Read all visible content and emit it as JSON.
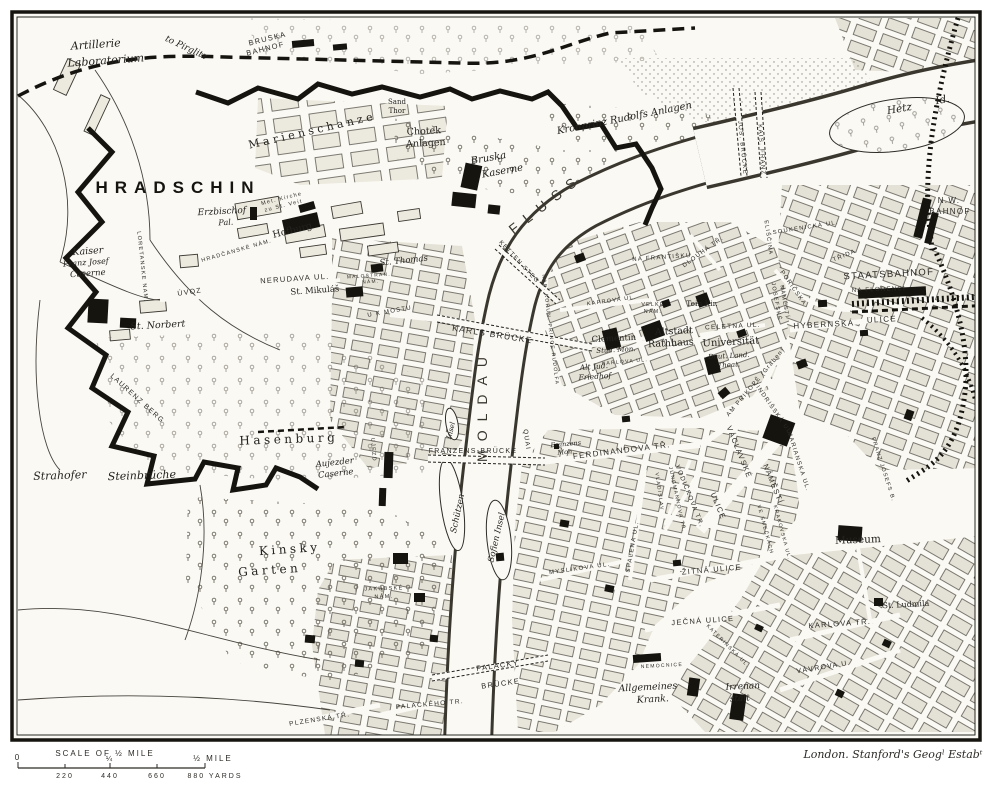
{
  "page": {
    "paper": "#faf9f4",
    "ink": "#24221e",
    "block_fill": "#e4e1d6",
    "imprint": "London. Stanford's Geogˡ Estabᵗ"
  },
  "scale_bar": {
    "title": "SCALE OF ½ MILE",
    "tick_zero": "0",
    "tick_quarter": "¼",
    "tick_half": "½ MILE",
    "yards_220": "220",
    "yards_440": "440",
    "yards_660": "660",
    "yards_880": "880 YARDS"
  },
  "map": {
    "labels": [
      {
        "t": "Artillerie",
        "x": 96,
        "y": 48,
        "r": -4,
        "s": 11,
        "f": "it"
      },
      {
        "t": "Laboratorium",
        "x": 106,
        "y": 64,
        "r": -4,
        "s": 11,
        "f": "it"
      },
      {
        "t": "to Pirglitz",
        "x": 185,
        "y": 50,
        "r": 25,
        "s": 9,
        "f": "it"
      },
      {
        "t": "BRUSKA",
        "x": 268,
        "y": 41,
        "r": -14,
        "s": 7.5,
        "f": "sp"
      },
      {
        "t": "BAHNOF",
        "x": 266,
        "y": 51,
        "r": -14,
        "s": 7.5,
        "f": "sp"
      },
      {
        "t": "Marienschanze",
        "x": 313,
        "y": 134,
        "r": -13,
        "s": 11,
        "f": "sp2"
      },
      {
        "t": "Sand",
        "x": 397,
        "y": 104,
        "r": 0,
        "s": 7,
        "f": "rm"
      },
      {
        "t": "Thor",
        "x": 397,
        "y": 113,
        "r": 0,
        "s": 7,
        "f": "rm"
      },
      {
        "t": "Chotek",
        "x": 424,
        "y": 134,
        "r": -3,
        "s": 9.5,
        "f": "rm"
      },
      {
        "t": "Anlagen",
        "x": 426,
        "y": 146,
        "r": -3,
        "s": 9.5,
        "f": "rm"
      },
      {
        "t": "Bruska",
        "x": 489,
        "y": 161,
        "r": -10,
        "s": 10,
        "f": "it"
      },
      {
        "t": "Kaserne",
        "x": 503,
        "y": 174,
        "r": -10,
        "s": 10,
        "f": "it"
      },
      {
        "t": "Kronprinz Rudolfs Anlagen",
        "x": 625,
        "y": 121,
        "r": -11,
        "s": 10,
        "f": "it"
      },
      {
        "t": "Hetz",
        "x": 900,
        "y": 112,
        "r": -10,
        "s": 10.5,
        "f": "it"
      },
      {
        "t": "Id.",
        "x": 943,
        "y": 103,
        "r": -10,
        "s": 10.5,
        "f": "it"
      },
      {
        "t": "N.W.",
        "x": 949,
        "y": 203,
        "r": 0,
        "s": 8,
        "f": "sp"
      },
      {
        "t": "BAHNOF",
        "x": 950,
        "y": 214,
        "r": 0,
        "s": 8,
        "f": "sp"
      },
      {
        "t": "KAIS. FRANZ",
        "x": 760,
        "y": 150,
        "r": 86,
        "s": 6,
        "f": "sp"
      },
      {
        "t": "JOS. BRÜCKE",
        "x": 741,
        "y": 148,
        "r": 84,
        "s": 6,
        "f": "sp"
      },
      {
        "t": "NA FRANTIŠKU",
        "x": 662,
        "y": 259,
        "r": -4,
        "s": 6,
        "f": "sp"
      },
      {
        "t": "HRADSCHIN",
        "x": 178,
        "y": 193,
        "r": 0,
        "s": 17,
        "f": "big"
      },
      {
        "t": "Erzbischof",
        "x": 222,
        "y": 214,
        "r": -3,
        "s": 9,
        "f": "it"
      },
      {
        "t": "Pal.",
        "x": 226,
        "y": 225,
        "r": -3,
        "s": 8,
        "f": "it"
      },
      {
        "t": "Met. Kirche",
        "x": 282,
        "y": 200,
        "r": -14,
        "s": 5.5,
        "f": "sp"
      },
      {
        "t": "zu St. Veit",
        "x": 284,
        "y": 207,
        "r": -14,
        "s": 5.5,
        "f": "sp"
      },
      {
        "t": "Hofburg",
        "x": 293,
        "y": 233,
        "r": -14,
        "s": 9.5,
        "f": "rm"
      },
      {
        "t": "Kaiser",
        "x": 88,
        "y": 254,
        "r": -4,
        "s": 9.5,
        "f": "it"
      },
      {
        "t": "Franz Josef",
        "x": 86,
        "y": 265,
        "r": -4,
        "s": 8,
        "f": "it"
      },
      {
        "t": "Caserne",
        "x": 88,
        "y": 276,
        "r": -4,
        "s": 8.5,
        "f": "it"
      },
      {
        "t": "LORETANSKE NAM.",
        "x": 141,
        "y": 267,
        "r": 84,
        "s": 5.5,
        "f": "sp"
      },
      {
        "t": "HRADČANSKÉ NÁM.",
        "x": 237,
        "y": 252,
        "r": -16,
        "s": 5.5,
        "f": "sp"
      },
      {
        "t": "NERUDAVA UL.",
        "x": 295,
        "y": 281,
        "r": -4,
        "s": 7.5,
        "f": "sp"
      },
      {
        "t": "St. Mikuláš",
        "x": 315,
        "y": 293,
        "r": -4,
        "s": 8.5,
        "f": "rm"
      },
      {
        "t": "ÚVOZ",
        "x": 190,
        "y": 294,
        "r": -8,
        "s": 7,
        "f": "sp"
      },
      {
        "t": "St. Norbert",
        "x": 158,
        "y": 328,
        "r": -3,
        "s": 9.5,
        "f": "it"
      },
      {
        "t": "LAURENZ BERG",
        "x": 136,
        "y": 400,
        "r": 42,
        "s": 7,
        "f": "sp"
      },
      {
        "t": "Strahofer",
        "x": 60,
        "y": 479,
        "r": -2,
        "s": 11,
        "f": "it"
      },
      {
        "t": "Steinbrüche",
        "x": 142,
        "y": 479,
        "r": -2,
        "s": 11,
        "f": "it"
      },
      {
        "t": "Hasenburg",
        "x": 289,
        "y": 443,
        "r": -2,
        "s": 12,
        "f": "sp2"
      },
      {
        "t": "Aujezder",
        "x": 335,
        "y": 465,
        "r": -6,
        "s": 8.5,
        "f": "it"
      },
      {
        "t": "Caserne",
        "x": 336,
        "y": 476,
        "r": -6,
        "s": 8.5,
        "f": "it"
      },
      {
        "t": "UJEZD",
        "x": 372,
        "y": 450,
        "r": 86,
        "s": 5.5,
        "f": "sp"
      },
      {
        "t": "Kinsky",
        "x": 290,
        "y": 553,
        "r": -4,
        "s": 12,
        "f": "sp2"
      },
      {
        "t": "Garten",
        "x": 270,
        "y": 574,
        "r": -4,
        "s": 12,
        "f": "sp2"
      },
      {
        "t": "JAKUBSKÉ",
        "x": 384,
        "y": 590,
        "r": -2,
        "s": 5.5,
        "f": "sp"
      },
      {
        "t": "NÁM.",
        "x": 384,
        "y": 598,
        "r": -2,
        "s": 5.5,
        "f": "sp"
      },
      {
        "t": "St. Thomas",
        "x": 404,
        "y": 263,
        "r": -6,
        "s": 8.5,
        "f": "it"
      },
      {
        "t": "MALOSTRAN.",
        "x": 369,
        "y": 277,
        "r": -4,
        "s": 4.8,
        "f": "sp"
      },
      {
        "t": "NÁM.",
        "x": 371,
        "y": 283,
        "r": -4,
        "s": 4.8,
        "f": "sp"
      },
      {
        "t": "U K MOSTU",
        "x": 390,
        "y": 313,
        "r": -10,
        "s": 6,
        "f": "sp"
      },
      {
        "t": "KARLS BRÜCKE",
        "x": 492,
        "y": 337,
        "r": 9,
        "s": 8.5,
        "f": "sp"
      },
      {
        "t": "KETTEN STEG",
        "x": 518,
        "y": 263,
        "r": 47,
        "s": 6,
        "f": "sp"
      },
      {
        "t": "MOLDAU",
        "x": 487,
        "y": 405,
        "r": -90,
        "s": 14,
        "f": "big2"
      },
      {
        "t": "FLUSS",
        "x": 549,
        "y": 207,
        "r": -38,
        "s": 14,
        "f": "big2"
      },
      {
        "t": "NAB. KORUN. PRINCE RUDOLFA",
        "x": 549,
        "y": 330,
        "r": 83,
        "s": 5,
        "f": "sp"
      },
      {
        "t": "Alt Jud.",
        "x": 594,
        "y": 369,
        "r": -4,
        "s": 7.5,
        "f": "it"
      },
      {
        "t": "Friedhof",
        "x": 595,
        "y": 379,
        "r": -4,
        "s": 7.5,
        "f": "it"
      },
      {
        "t": "KAPROVA UL.",
        "x": 612,
        "y": 302,
        "r": -8,
        "s": 5.5,
        "f": "sp"
      },
      {
        "t": "DLOUHÁ TŘ.",
        "x": 704,
        "y": 253,
        "r": -36,
        "s": 6,
        "f": "sp"
      },
      {
        "t": "VELKÉ",
        "x": 653,
        "y": 306,
        "r": 0,
        "s": 5.2,
        "f": "sp"
      },
      {
        "t": "NÁM.",
        "x": 653,
        "y": 313,
        "r": 0,
        "s": 5.2,
        "f": "sp"
      },
      {
        "t": "Tein Kir.",
        "x": 702,
        "y": 306,
        "r": 0,
        "s": 7.5,
        "f": "rm"
      },
      {
        "t": "Altstadt",
        "x": 674,
        "y": 334,
        "r": -3,
        "s": 9.5,
        "f": "rm"
      },
      {
        "t": "Rathhaus",
        "x": 671,
        "y": 346,
        "r": -3,
        "s": 9.5,
        "f": "rm"
      },
      {
        "t": "Clementin",
        "x": 614,
        "y": 341,
        "r": -3,
        "s": 8.5,
        "f": "rm"
      },
      {
        "t": "Stud. Mon.",
        "x": 616,
        "y": 352,
        "r": -3,
        "s": 7,
        "f": "it"
      },
      {
        "t": "KARLOVA UL.",
        "x": 625,
        "y": 363,
        "r": -5,
        "s": 5,
        "f": "sp"
      },
      {
        "t": "CELETNA UL.",
        "x": 733,
        "y": 328,
        "r": -3,
        "s": 6.5,
        "f": "sp"
      },
      {
        "t": "Universität",
        "x": 731,
        "y": 345,
        "r": -3,
        "s": 10,
        "f": "rm"
      },
      {
        "t": "Deut. Land.",
        "x": 729,
        "y": 358,
        "r": -3,
        "s": 7,
        "f": "it"
      },
      {
        "t": "Theat.",
        "x": 729,
        "y": 367,
        "r": -3,
        "s": 7,
        "f": "it"
      },
      {
        "t": "JOSEFSKÉ",
        "x": 775,
        "y": 302,
        "r": 80,
        "s": 5.5,
        "f": "sp"
      },
      {
        "t": "NÁMĚSTÍ",
        "x": 783,
        "y": 302,
        "r": 80,
        "s": 5.5,
        "f": "sp"
      },
      {
        "t": "AM PRIKOPĚ (Graben)",
        "x": 757,
        "y": 383,
        "r": -50,
        "s": 6,
        "f": "sp"
      },
      {
        "t": "PORIČSKA",
        "x": 792,
        "y": 289,
        "r": 55,
        "s": 6,
        "f": "sp"
      },
      {
        "t": "SOUKENICKÁ UL.",
        "x": 806,
        "y": 229,
        "r": -9,
        "s": 5.8,
        "f": "sp"
      },
      {
        "t": "ELIŠČINA",
        "x": 767,
        "y": 238,
        "r": 82,
        "s": 5.5,
        "f": "sp"
      },
      {
        "t": "TŘIDA",
        "x": 845,
        "y": 257,
        "r": -22,
        "s": 6,
        "f": "sp"
      },
      {
        "t": "STAATSBAHNOF",
        "x": 889,
        "y": 277,
        "r": -3,
        "s": 9.5,
        "f": "sp"
      },
      {
        "t": "NA FLORENCI",
        "x": 879,
        "y": 291,
        "r": -2,
        "s": 6,
        "f": "sp"
      },
      {
        "t": "HYBERNSKÁ",
        "x": 824,
        "y": 327,
        "r": -3,
        "s": 8,
        "f": "sp"
      },
      {
        "t": "ULICE",
        "x": 882,
        "y": 322,
        "r": -3,
        "s": 8,
        "f": "sp"
      },
      {
        "t": "QUAI",
        "x": 525,
        "y": 440,
        "r": 82,
        "s": 6.5,
        "f": "sp"
      },
      {
        "t": "FRANZENS-BRÜCKE",
        "x": 473,
        "y": 453,
        "r": 0,
        "s": 7,
        "f": "sp"
      },
      {
        "t": "Franzens",
        "x": 566,
        "y": 446,
        "r": -5,
        "s": 6.5,
        "f": "it"
      },
      {
        "t": "Mon.",
        "x": 566,
        "y": 454,
        "r": -5,
        "s": 6.5,
        "f": "it"
      },
      {
        "t": "FERDINANDOVA TŘ.",
        "x": 622,
        "y": 453,
        "r": -7,
        "s": 8,
        "f": "sp"
      },
      {
        "t": "Insel",
        "x": 453,
        "y": 431,
        "r": -76,
        "s": 7,
        "f": "it"
      },
      {
        "t": "Schützen",
        "x": 460,
        "y": 514,
        "r": -78,
        "s": 8.5,
        "f": "it"
      },
      {
        "t": "Sofien Insel",
        "x": 499,
        "y": 538,
        "r": -77,
        "s": 8.5,
        "f": "it"
      },
      {
        "t": "VÁCLAVSKÉ",
        "x": 737,
        "y": 453,
        "r": 68,
        "s": 7.5,
        "f": "sp"
      },
      {
        "t": "ULICE",
        "x": 716,
        "y": 507,
        "r": 68,
        "s": 7.5,
        "f": "sp"
      },
      {
        "t": "NÁMĚSTÍ",
        "x": 771,
        "y": 485,
        "r": 68,
        "s": 7.5,
        "f": "sp"
      },
      {
        "t": "JINDRIŠSKÁ UL.",
        "x": 772,
        "y": 410,
        "r": 55,
        "s": 6,
        "f": "sp"
      },
      {
        "t": "MARIANSKA UL.",
        "x": 797,
        "y": 462,
        "r": 72,
        "s": 6,
        "f": "sp"
      },
      {
        "t": "VODIČKOVA TR.",
        "x": 688,
        "y": 497,
        "r": 68,
        "s": 6.5,
        "f": "sp"
      },
      {
        "t": "JUNGMANNOVA TŘ.",
        "x": 676,
        "y": 500,
        "r": 78,
        "s": 5,
        "f": "sp"
      },
      {
        "t": "VLADISLAV",
        "x": 658,
        "y": 492,
        "r": 82,
        "s": 5,
        "f": "sp"
      },
      {
        "t": "SPALENA UL.",
        "x": 634,
        "y": 547,
        "r": -80,
        "s": 6,
        "f": "sp"
      },
      {
        "t": "MYSLIKOVA UL.",
        "x": 580,
        "y": 570,
        "r": -8,
        "s": 6,
        "f": "sp"
      },
      {
        "t": "VE SMEČKÁCH",
        "x": 764,
        "y": 530,
        "r": 75,
        "s": 5,
        "f": "sp"
      },
      {
        "t": "KRAKOVSKA UL.",
        "x": 781,
        "y": 533,
        "r": 75,
        "s": 5,
        "f": "sp"
      },
      {
        "t": "ŽITNÁ ULICE",
        "x": 712,
        "y": 572,
        "r": -5,
        "s": 7.5,
        "f": "sp"
      },
      {
        "t": "JEČNÁ ULICE",
        "x": 703,
        "y": 623,
        "r": -4,
        "s": 7.5,
        "f": "sp"
      },
      {
        "t": "KATERINSKÁ UL.",
        "x": 727,
        "y": 647,
        "r": 45,
        "s": 5,
        "f": "sp"
      },
      {
        "t": "NEMOCNICE",
        "x": 662,
        "y": 667,
        "r": -3,
        "s": 5,
        "f": "sp"
      },
      {
        "t": "Allgemeines",
        "x": 648,
        "y": 690,
        "r": -3,
        "s": 9.5,
        "f": "it"
      },
      {
        "t": "Krank.",
        "x": 653,
        "y": 702,
        "r": -3,
        "s": 9.5,
        "f": "it"
      },
      {
        "t": "Irrenan",
        "x": 743,
        "y": 689,
        "r": -3,
        "s": 9,
        "f": "it"
      },
      {
        "t": "stalt",
        "x": 740,
        "y": 701,
        "r": -3,
        "s": 9,
        "f": "it"
      },
      {
        "t": "PALACKY",
        "x": 498,
        "y": 668,
        "r": -8,
        "s": 7.5,
        "f": "sp"
      },
      {
        "t": "BRÜCKE",
        "x": 501,
        "y": 686,
        "r": -8,
        "s": 7.5,
        "f": "sp"
      },
      {
        "t": "PALACKÉHO TR.",
        "x": 430,
        "y": 706,
        "r": -5,
        "s": 6.5,
        "f": "sp"
      },
      {
        "t": "PLZENSKÁ TŘ.",
        "x": 320,
        "y": 721,
        "r": -9,
        "s": 6.5,
        "f": "sp"
      },
      {
        "t": "Museum",
        "x": 858,
        "y": 543,
        "r": -2,
        "s": 10.5,
        "f": "rm"
      },
      {
        "t": "St. Ludmila",
        "x": 906,
        "y": 607,
        "r": -3,
        "s": 8,
        "f": "rm"
      },
      {
        "t": "KARLOVA TŘ.",
        "x": 840,
        "y": 626,
        "r": -4,
        "s": 7.5,
        "f": "sp"
      },
      {
        "t": "VÁVROVA U.",
        "x": 824,
        "y": 669,
        "r": -9,
        "s": 7,
        "f": "sp"
      },
      {
        "t": "FRANZ JOSEFS B.",
        "x": 882,
        "y": 470,
        "r": 72,
        "s": 5.5,
        "f": "sp"
      }
    ]
  }
}
